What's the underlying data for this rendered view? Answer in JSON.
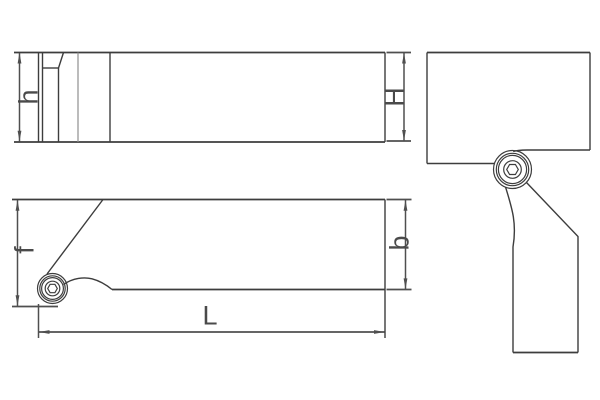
{
  "drawing": {
    "type": "technical-drawing",
    "subject": "external turning tool holder with round insert, three orthographic views",
    "labels": {
      "height_left": "h",
      "height_right": "H",
      "head_offset": "f",
      "shank_width": "b",
      "total_length": "L"
    },
    "colors": {
      "outline": "#3d3d3d",
      "dimension": "#4f4f4f",
      "hidden_line": "#8f8f8f",
      "background": "#ffffff"
    }
  }
}
